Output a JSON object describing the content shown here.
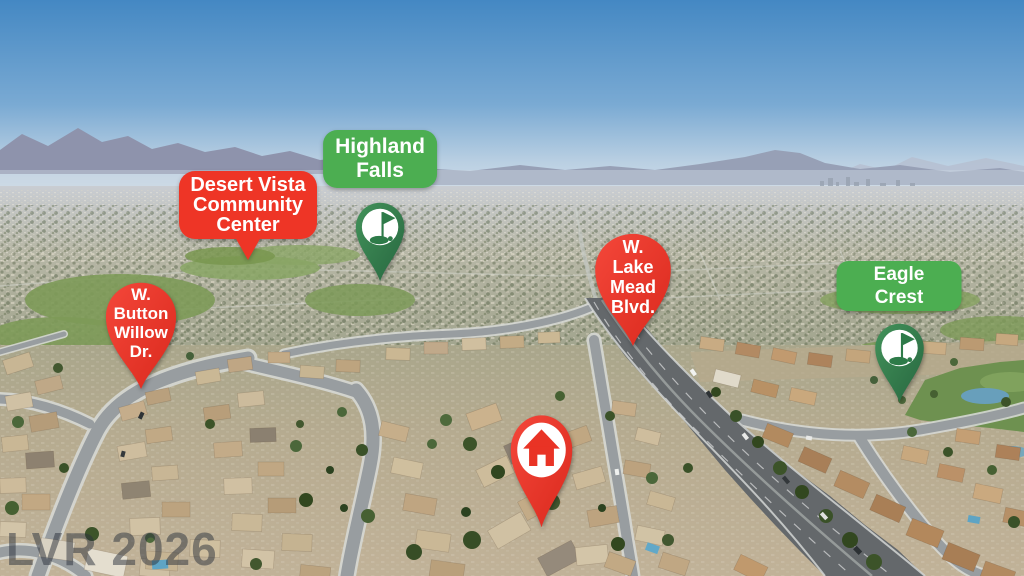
{
  "watermark": {
    "text": "LVR 2026"
  },
  "colors": {
    "marker_red": "#ee3526",
    "label_green": "#4cae51",
    "pin_green": "#2f7b4b",
    "watermark_gray": "#2b313b"
  },
  "markers": {
    "desert_vista": {
      "lines": [
        "Desert Vista",
        "Community",
        "Center"
      ]
    },
    "highland_falls": {
      "lines": [
        "Highland",
        "Falls"
      ]
    },
    "button_willow": {
      "lines": [
        "W.",
        "Button",
        "Willow",
        "Dr."
      ]
    },
    "lake_mead": {
      "lines": [
        "W.",
        "Lake",
        "Mead",
        "Blvd."
      ]
    },
    "eagle_crest": {
      "lines": [
        "Eagle Crest"
      ]
    },
    "subject_home": {
      "icon": "house"
    }
  }
}
